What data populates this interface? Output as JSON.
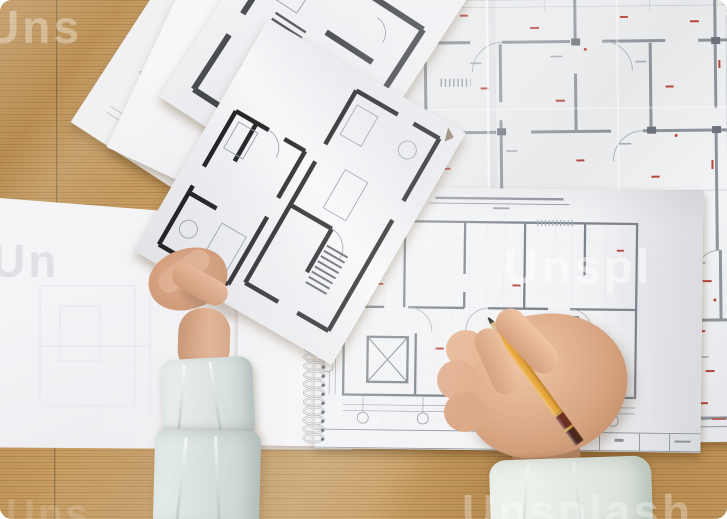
{
  "alt": "Overhead photo of an architect's desk: printed floor-plan blueprints on a wooden table, a left hand holding a plan sheet and a right hand drawing on a spiral-bound blueprint pad with a yellow pencil",
  "watermark": {
    "brand": "Unsplash",
    "color": "#ffffff",
    "fragments": [
      {
        "id": "top-left",
        "text": "Uns"
      },
      {
        "id": "mid-right",
        "text": "Unspl"
      },
      {
        "id": "bottom-center",
        "text": "Unsplash"
      },
      {
        "id": "bottom-left",
        "text": "Uns"
      },
      {
        "id": "left-paper",
        "text": "Un"
      }
    ]
  },
  "palette": {
    "wood": "#c09457",
    "wood_dark": "#a57b3f",
    "wood_light": "#cfa468",
    "paper_white": "#f4f4f6",
    "paper_gray": "#e9eaec",
    "blueprint_wall": "#8d939b",
    "bold_wall": "#26282a",
    "red_annotation": "#b4463b",
    "skin": "#d7a183",
    "sleeve_left": "#d6dedd",
    "sleeve_right": "#e8ece9",
    "pencil_yellow": "#eaa93f",
    "pencil_band": "#6e2b26"
  },
  "objects": {
    "desk": "wooden desk",
    "pad": "spiral-bound blueprint pad",
    "pencil": "yellow graphite pencil",
    "sheets": [
      "fine-line plan sheet",
      "blank sheet",
      "bold plan sheet",
      "held plan sheet",
      "large annotated blueprint"
    ]
  }
}
